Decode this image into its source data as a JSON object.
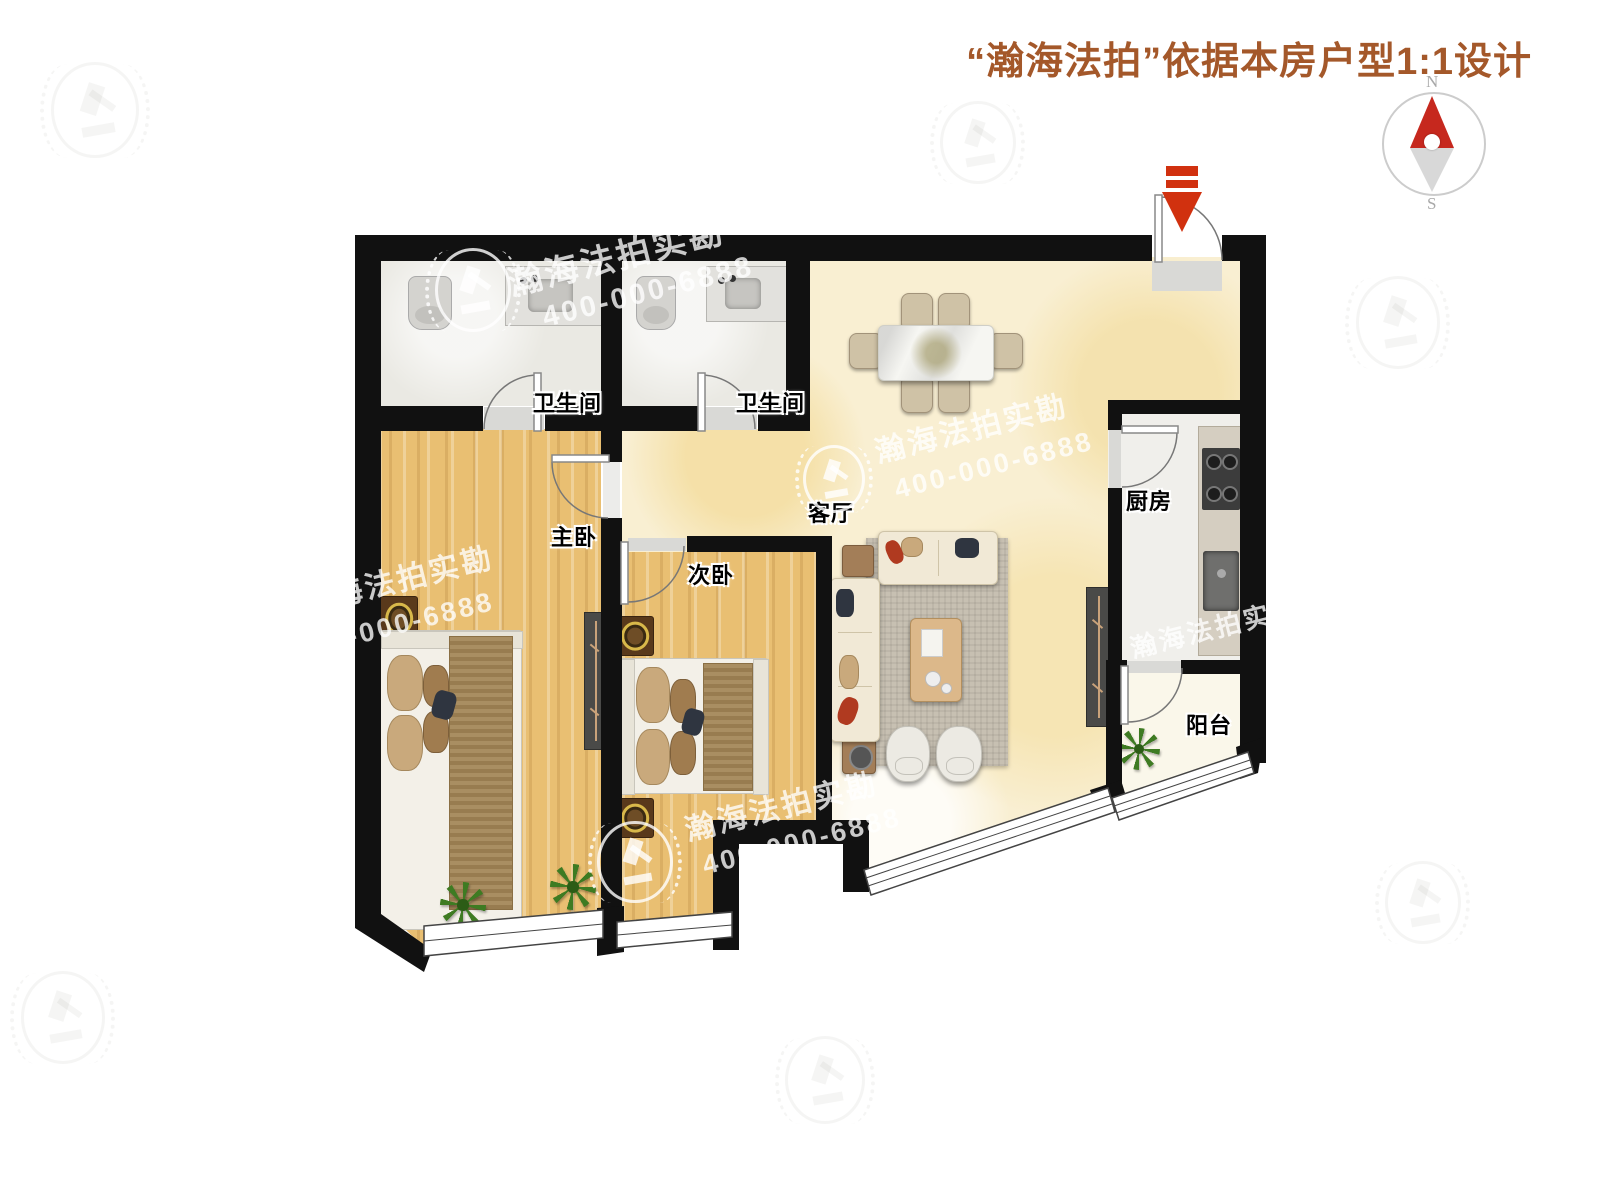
{
  "header": {
    "title": "“瀚海法拍”依据本房户型1:1设计"
  },
  "compass": {
    "north": "N",
    "south": "S"
  },
  "rooms": [
    {
      "id": "bathroom-1",
      "label": "卫生间"
    },
    {
      "id": "bathroom-2",
      "label": "卫生间"
    },
    {
      "id": "master-bedroom",
      "label": "主卧"
    },
    {
      "id": "second-bedroom",
      "label": "次卧"
    },
    {
      "id": "living-room",
      "label": "客厅"
    },
    {
      "id": "kitchen",
      "label": "厨房"
    },
    {
      "id": "balcony",
      "label": "阳台"
    }
  ],
  "watermark": {
    "brand": "瀚海法拍实勘",
    "phone": "400-000-6888",
    "brand_partial": "海法拍实勘",
    "phone_partial": "0-000-6888"
  },
  "colors": {
    "title_brown": "#a4582a",
    "accent_red": "#d1310f",
    "compass_red": "#c6281e",
    "wall_black": "#111111",
    "wood_floor": "#e9bf72",
    "marble_floor": "#f9efd2"
  }
}
